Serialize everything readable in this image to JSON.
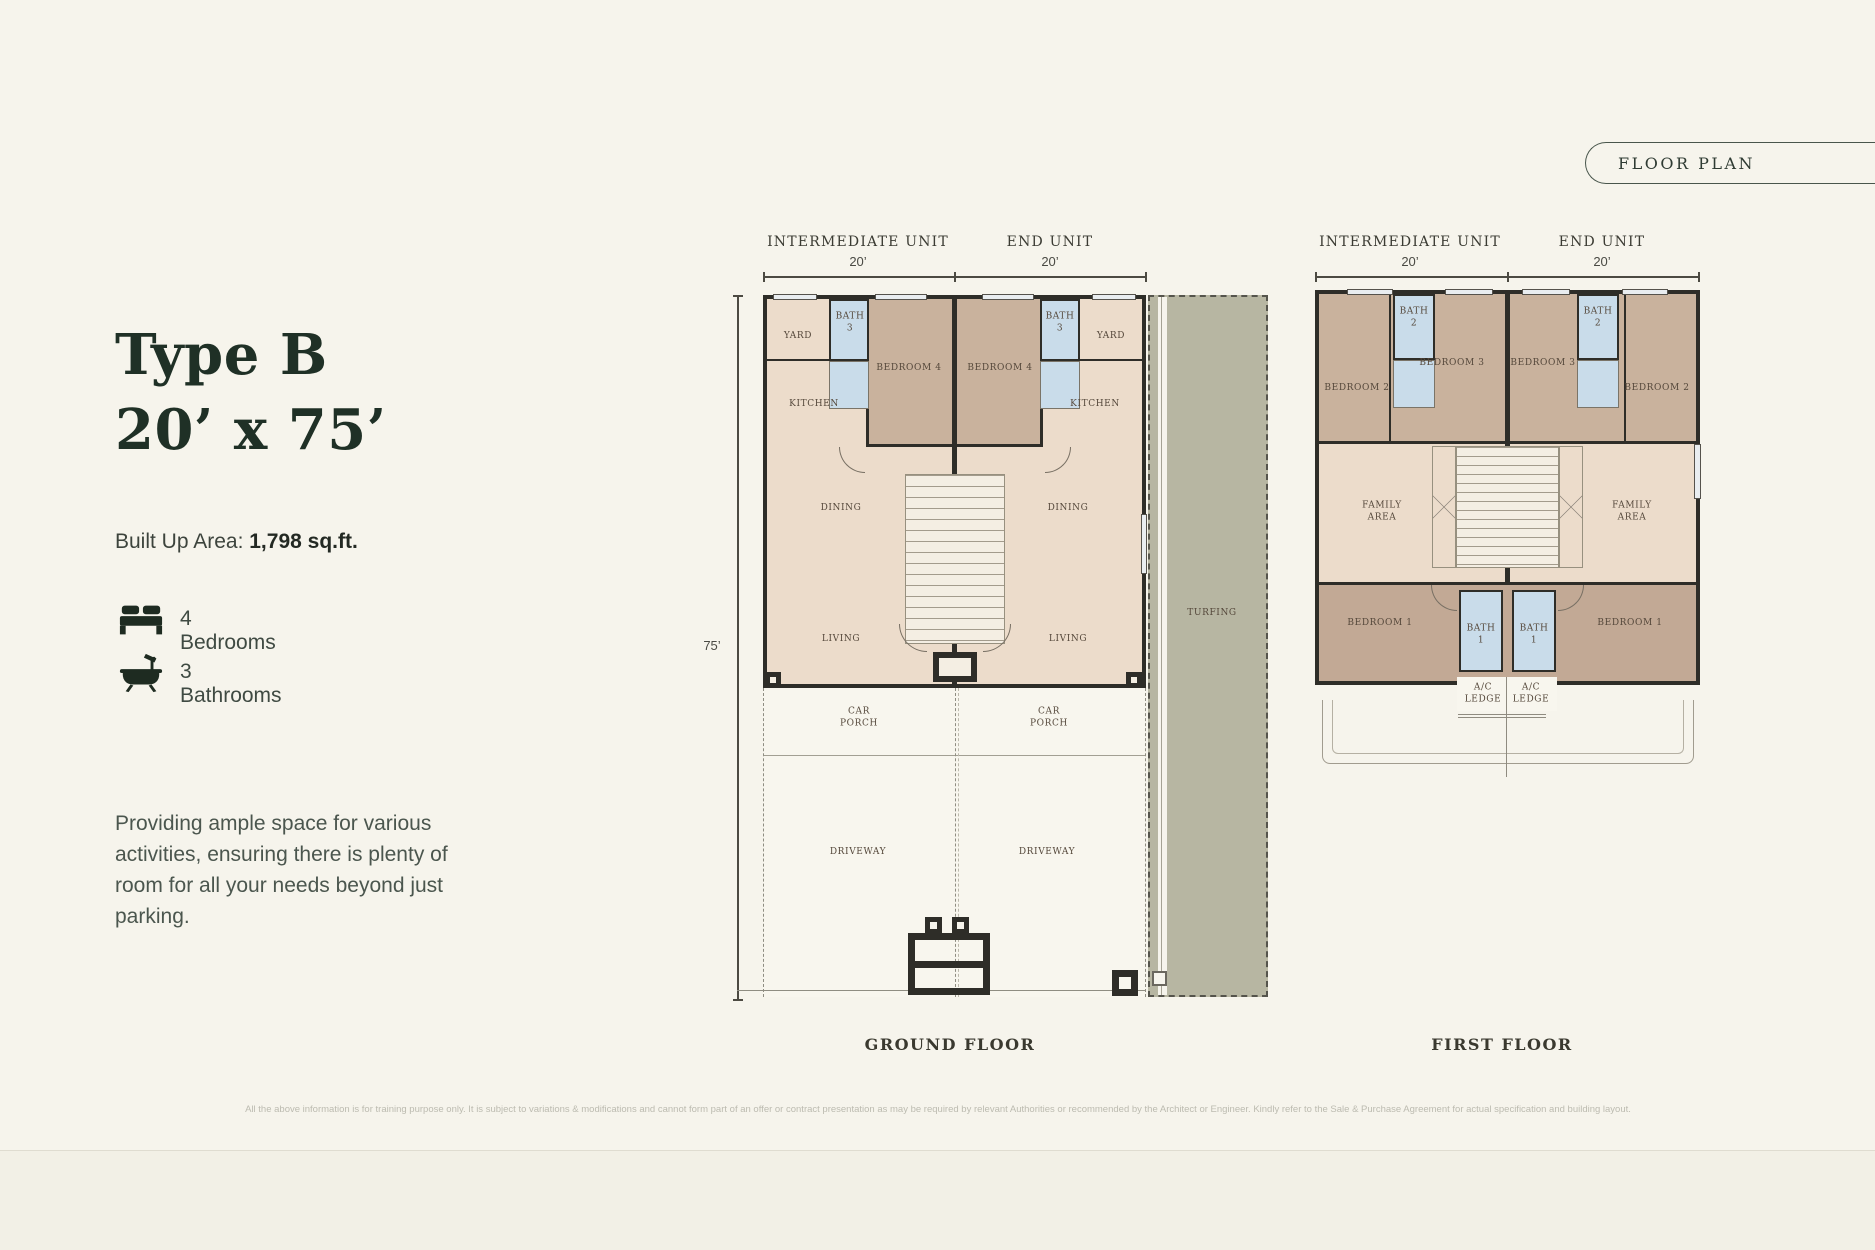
{
  "badge": {
    "label": "FLOOR PLAN"
  },
  "info": {
    "title_line1": "Type B",
    "title_line2": "20’ x 75’",
    "built_up_label": "Built Up Area:",
    "built_up_value": "1,798 sq.ft.",
    "features": [
      {
        "icon": "bed-icon",
        "label": "4 Bedrooms"
      },
      {
        "icon": "bathtub-icon",
        "label": "3 Bathrooms"
      }
    ],
    "description": "Providing ample space for various activities, ensuring there is plenty of room for all your needs beyond just parking."
  },
  "dimensions": {
    "intermediate_unit": "INTERMEDIATE UNIT",
    "end_unit": "END UNIT",
    "unit_width": "20’",
    "depth": "75’"
  },
  "ground_floor": {
    "caption": "GROUND FLOOR",
    "rooms": {
      "yard": "YARD",
      "bath": "BATH 3",
      "bedroom": "BEDROOM 4",
      "kitchen": "KITCHEN",
      "dining": "DINING",
      "living": "LIVING",
      "car_porch": "CAR PORCH",
      "driveway": "DRIVEWAY",
      "turfing": "TURFING"
    }
  },
  "first_floor": {
    "caption": "FIRST FLOOR",
    "rooms": {
      "bedroom2": "BEDROOM 2",
      "bedroom3": "BEDROOM 3",
      "bath2": "BATH 2",
      "family_area": "FAMILY AREA",
      "bedroom1": "BEDROOM 1",
      "bath1": "BATH 1",
      "ac_ledge": "A/C LEDGE"
    }
  },
  "disclaimer": "All the above information is for training purpose only. It is subject to variations & modifications and cannot form part of an offer or contract presentation as may be required by relevant Authorities or recommended by the Architect or Engineer. Kindly refer to the Sale & Purchase Agreement for actual specification and building layout.",
  "colors": {
    "accent": "#1f3026",
    "wall": "#2e2d28",
    "wheat": "#ecdccb",
    "brown": "#c9b29d",
    "brown_dark": "#c2a995",
    "bath_blue": "#c9dcea",
    "turf": "#b7b6a2"
  }
}
